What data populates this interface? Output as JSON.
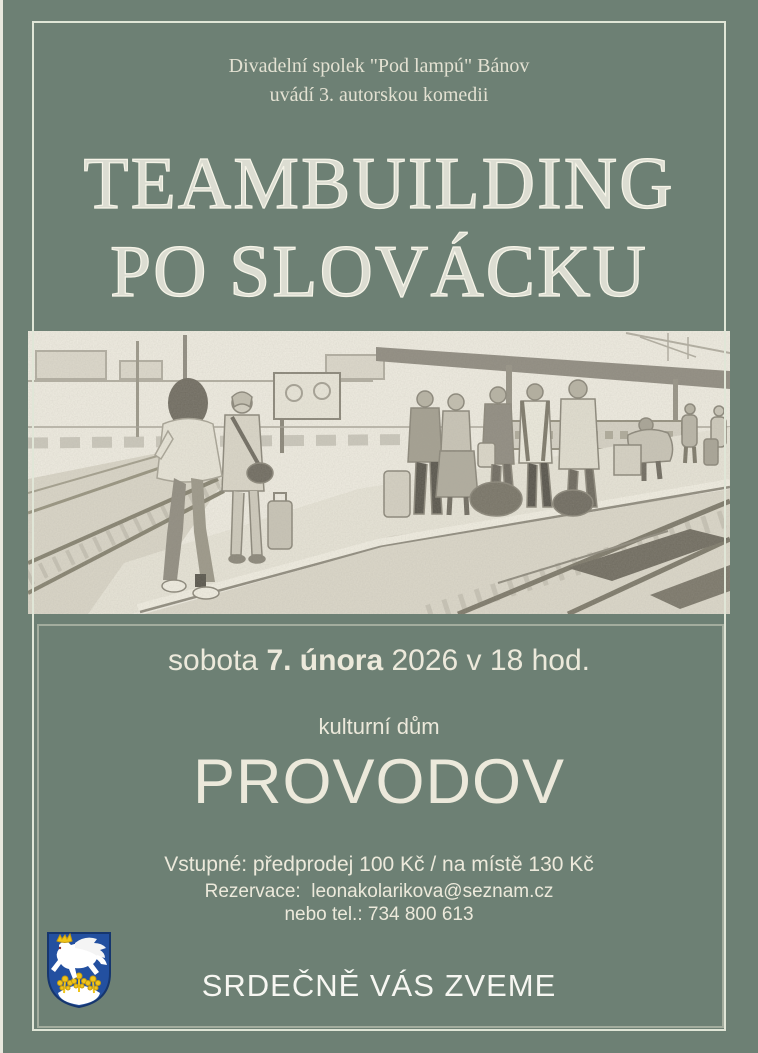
{
  "poster": {
    "organizer_line1": "Divadelní spolek \"Pod lampú\" Bánov",
    "organizer_line2": "uvádí 3. autorskou komedii",
    "title_line1": "TEAMBUILDING",
    "title_line2": "PO SLOVÁCKU",
    "date_prefix": "sobota ",
    "date_bold": "7. února",
    "date_suffix": " 2026 v 18 hod.",
    "venue_type": "kulturní dům",
    "venue_name": "PROVODOV",
    "price_line": "Vstupné: předprodej 100 Kč / na místě 130 Kč",
    "reservation_line": "Rezervace:  leonakolarikova@seznam.cz",
    "phone_line": "nebo tel.: 734 800 613",
    "closing_line": "SRDEČNĚ VÁS ZVEME"
  },
  "photo": {
    "description": "grainy black-and-white sketch of travelers with suitcases waiting on a railway platform"
  },
  "crest": {
    "description": "Provodov coat of arms: white leaping horse with golden crown over yellow flowers on a white mound, blue shield"
  },
  "colors": {
    "background": "#6d8074",
    "outer_border": "#e0e6d7",
    "inner_border": "#a3ad9e",
    "title_text": "#f4f2e6",
    "body_text": "#ece9db",
    "closing_text": "#f7f7f2",
    "crest_blue": "#2350a0",
    "crest_yellow": "#f0c419"
  }
}
